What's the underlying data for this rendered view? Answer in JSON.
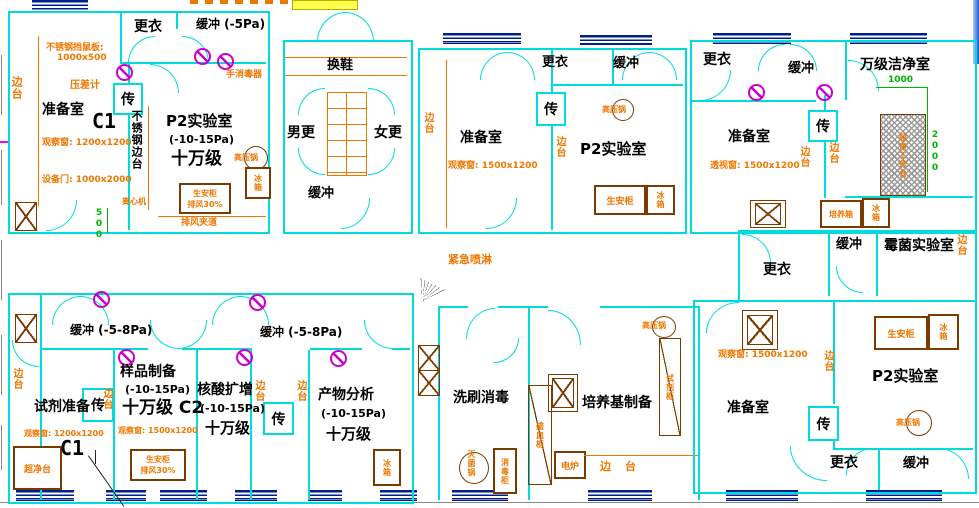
{
  "drawing": {
    "type": "laboratory-floor-plan-cad",
    "colors": {
      "wall": "#00dcdc",
      "annotation": "#ee7700",
      "window_symbol": "#001e8c",
      "dimension": "#00b400",
      "valve": "#cc00cc",
      "equipment_border": "#7a3a00"
    }
  },
  "s": {
    "changing": "更衣",
    "buffer": "缓冲",
    "buffer_m5": "缓冲 (-5Pa)",
    "buffer_m58": "缓冲 (-5-8Pa)",
    "prep_room": "准备室",
    "p2_lab": "P2实验室",
    "pa_range": "(-10-15Pa)",
    "class_100k": "十万级",
    "class_100k_c2": "十万级 C2",
    "c1": "C1",
    "pass": "传",
    "side_bench": "边台",
    "ss_bench": "不锈钢边台",
    "ss_rat_guard": "不锈钢挡鼠板:",
    "ss_rat_guard_size": "1000x500",
    "pressure_gauge": "压差计",
    "obs_1200": "观察窗: 1200x1200",
    "obs_1500": "观察窗: 1500x1200",
    "see_1500": "透视窗: 1500x1200",
    "equip_door": "设备门: 1000x2000",
    "hand_disinfector": "手消毒器",
    "centrifuge": "离心机",
    "autoclave": "高压锅",
    "fridge": "冰箱",
    "bsc": "生安柜",
    "bsc_exhaust": "排风30%",
    "exhaust_passage": "排风夹道",
    "dim_500": "500",
    "shoe_change": "换鞋",
    "men_changing": "男更",
    "women_changing": "女更",
    "clean_room_10k": "万级洁净室",
    "dim_1000": "1000",
    "dim_2000": "2000",
    "clean_work_bench": "超净工作台",
    "incubator": "培养箱",
    "mold_lab": "霉菌实验室",
    "emergency_shower": "紧急喷淋",
    "reagent_prep": "试剂准备",
    "clean_bench": "超净台",
    "sample_prep": "样品制备",
    "nucleic_amp": "核酸扩增",
    "product_analysis": "产物分析",
    "washing_disinfection": "洗刷消毒",
    "sterilizer_pot": "灭菌锅",
    "disinfect_cabinet": "消毒柜",
    "dish_cabinet": "盛皿柜",
    "medium_prep": "培养基制备",
    "reagent_cabinet": "试剂柜",
    "electric_stove": "电炉"
  }
}
